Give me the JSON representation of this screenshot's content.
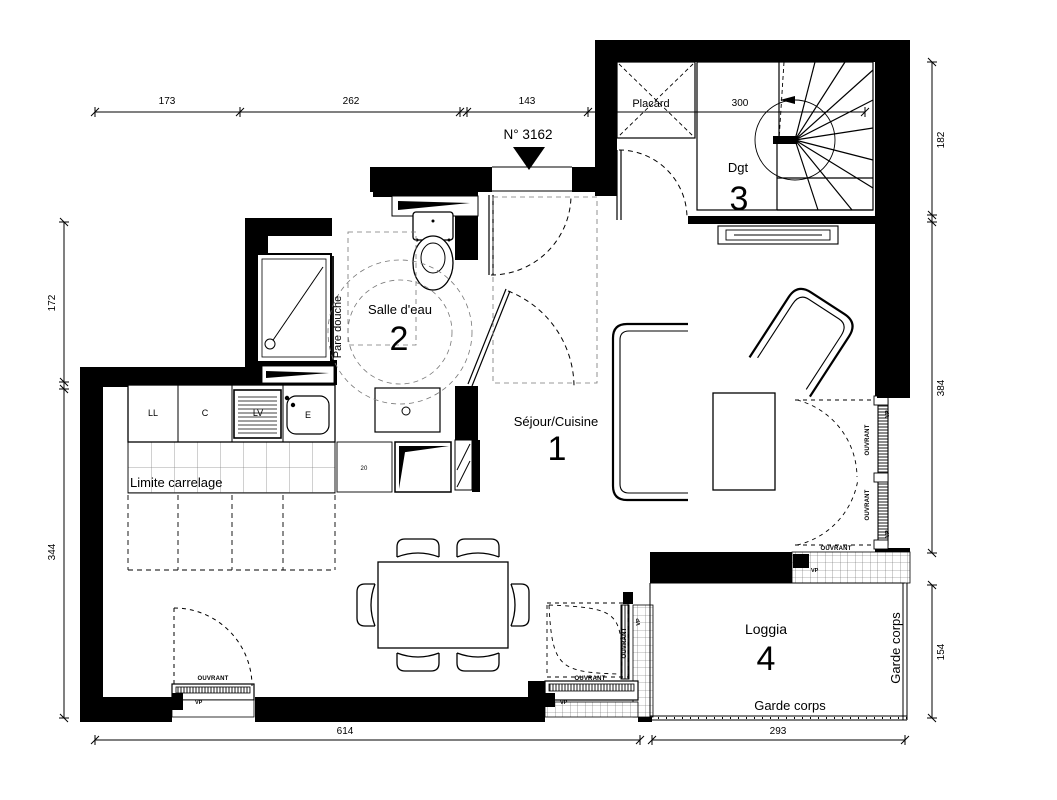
{
  "unit": {
    "number_label": "N° 3162"
  },
  "rooms": {
    "sejour": {
      "name": "Séjour/Cuisine",
      "num": "1"
    },
    "salle_eau": {
      "name": "Salle d'eau",
      "num": "2"
    },
    "dgt": {
      "name": "Dgt",
      "num": "3"
    },
    "loggia": {
      "name": "Loggia",
      "num": "4"
    },
    "placard": {
      "name": "Placard"
    }
  },
  "annotations": {
    "pare_douche": "Pare douche",
    "limite_carrelage": "Limite carrelage",
    "garde_corps": "Garde corps",
    "ouvrant": "OUVRANT",
    "vp": "VP",
    "small_20": "20"
  },
  "kitchen": {
    "units": [
      "LL",
      "C",
      "LV",
      "E"
    ]
  },
  "dimensions": {
    "top": [
      "173",
      "262",
      "143",
      "300"
    ],
    "left": [
      "172",
      "344"
    ],
    "right": [
      "182",
      "384",
      "154"
    ],
    "bottom": [
      "614",
      "293"
    ]
  },
  "colors": {
    "wall": "#000000",
    "line": "#000000",
    "background": "#ffffff",
    "tile_line": "#888888"
  }
}
